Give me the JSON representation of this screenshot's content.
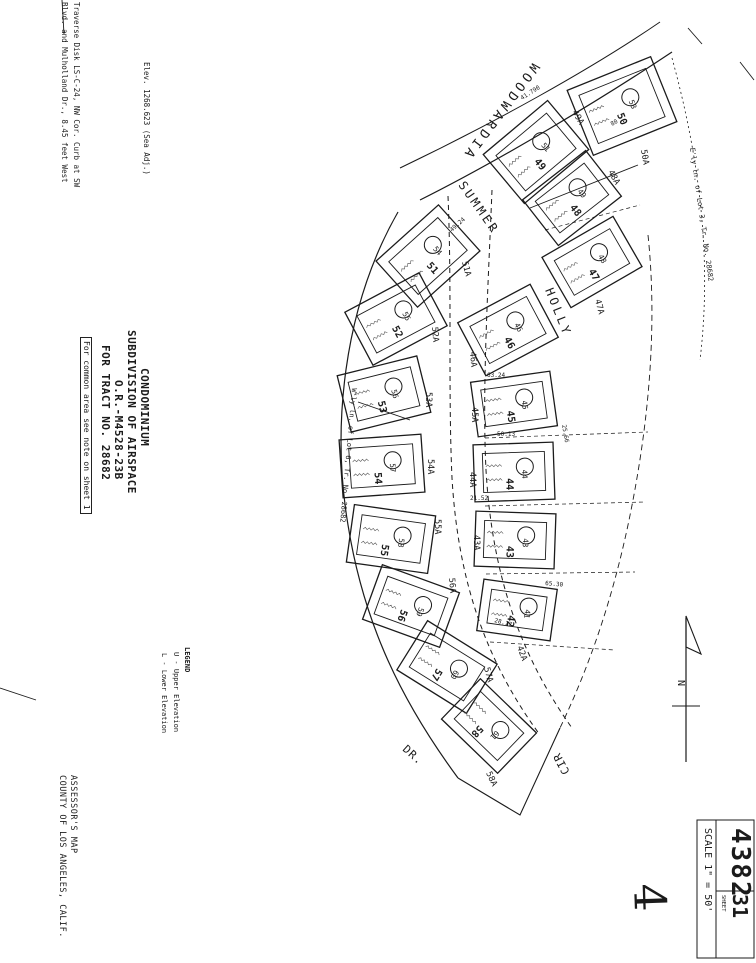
{
  "page_bg": "#ffffff",
  "ink_color": "#1b1b1b",
  "margin_notes": {
    "traverse_line1": "Traverse Disk LS-C-24, NW Cor. Curb at SW",
    "traverse_line2": "Blvd. and Mulholland Dr., 8.45 feet West",
    "elevation_note": "Elev. 1268.623  (Sea Adj.)"
  },
  "title_block": {
    "line1": "CONDOMINIUM",
    "line2": "SUBDIVISION OF AIRSPACE",
    "line3": "O.R.-M4528-23B",
    "line4": "FOR TRACT NO. 28682",
    "boxed_note": "For common area see note on sheet 1"
  },
  "legend": {
    "title": "LEGEND",
    "items": [
      "U - Upper Elevation",
      "L - Lower Elevation"
    ]
  },
  "footer": {
    "line1": "ASSESSOR'S MAP",
    "line2": "COUNTY OF LOS ANGELES, CALIF."
  },
  "sheet_box": {
    "book": "4382",
    "sheet": "31",
    "sheet_label": "SHEET",
    "scale": "SCALE 1\" = 50'"
  },
  "boundary_notes": {
    "east": "E'ly ln. of Lot 3, Tr. No. 28682",
    "west": "W'ly ln. of Lot 6, Tr. No. 28682"
  },
  "north_label": "N",
  "handwritten_mark": "4",
  "map": {
    "streets": [
      {
        "id": "woodwardia",
        "name": "WOODWARDIA"
      },
      {
        "id": "summer",
        "name": "SUMMER"
      },
      {
        "id": "holly",
        "name": "HOLLY"
      },
      {
        "id": "dr",
        "name": "DR."
      },
      {
        "id": "cir",
        "name": "CIR"
      }
    ],
    "parcels": [
      {
        "lot": "49",
        "unit": "51",
        "cx": 536,
        "cy": 152,
        "w": 84,
        "h": 64,
        "rot": -40
      },
      {
        "lot": "50",
        "unit": "53",
        "cx": 622,
        "cy": 106,
        "w": 90,
        "h": 70,
        "rot": -22
      },
      {
        "lot": "48",
        "unit": "49",
        "cx": 572,
        "cy": 198,
        "w": 80,
        "h": 58,
        "rot": -38
      },
      {
        "lot": "47",
        "unit": "48",
        "cx": 592,
        "cy": 262,
        "w": 82,
        "h": 58,
        "rot": -30
      },
      {
        "lot": "46",
        "unit": "46",
        "cx": 508,
        "cy": 330,
        "w": 82,
        "h": 60,
        "rot": -28
      },
      {
        "lot": "45",
        "unit": "45",
        "cx": 514,
        "cy": 404,
        "w": 80,
        "h": 55,
        "rot": -8
      },
      {
        "lot": "44",
        "unit": "44",
        "cx": 514,
        "cy": 472,
        "w": 80,
        "h": 57,
        "rot": -2
      },
      {
        "lot": "43",
        "unit": "43",
        "cx": 515,
        "cy": 540,
        "w": 80,
        "h": 55,
        "rot": 2
      },
      {
        "lot": "42",
        "unit": "41",
        "cx": 517,
        "cy": 610,
        "w": 74,
        "h": 52,
        "rot": 8
      },
      {
        "lot": "51",
        "unit": "54",
        "cx": 428,
        "cy": 256,
        "w": 84,
        "h": 62,
        "rot": -42
      },
      {
        "lot": "52",
        "unit": "55",
        "cx": 396,
        "cy": 319,
        "w": 84,
        "h": 60,
        "rot": -28
      },
      {
        "lot": "53",
        "unit": "56",
        "cx": 384,
        "cy": 394,
        "w": 82,
        "h": 58,
        "rot": -14
      },
      {
        "lot": "54",
        "unit": "57",
        "cx": 382,
        "cy": 466,
        "w": 82,
        "h": 58,
        "rot": -4
      },
      {
        "lot": "55",
        "unit": "58",
        "cx": 391,
        "cy": 539,
        "w": 82,
        "h": 58,
        "rot": 8
      },
      {
        "lot": "56",
        "unit": "59",
        "cx": 411,
        "cy": 606,
        "w": 82,
        "h": 58,
        "rot": 20
      },
      {
        "lot": "57",
        "unit": "60",
        "cx": 447,
        "cy": 667,
        "w": 82,
        "h": 58,
        "rot": 32
      },
      {
        "lot": "58",
        "unit": "61",
        "cx": 489,
        "cy": 726,
        "w": 78,
        "h": 56,
        "rot": 44
      }
    ],
    "lot_labels": [
      {
        "text": "49A",
        "x": 572,
        "y": 112,
        "rot": 60
      },
      {
        "text": "50A",
        "x": 641,
        "y": 150,
        "rot": 80
      },
      {
        "text": "48A",
        "x": 608,
        "y": 172,
        "rot": 60
      },
      {
        "text": "47A",
        "x": 595,
        "y": 300,
        "rot": 75
      },
      {
        "text": "51A",
        "x": 462,
        "y": 262,
        "rot": 75
      },
      {
        "text": "52A",
        "x": 432,
        "y": 327,
        "rot": 85
      },
      {
        "text": "46A",
        "x": 470,
        "y": 352,
        "rot": 85
      },
      {
        "text": "53A",
        "x": 426,
        "y": 392,
        "rot": 90
      },
      {
        "text": "45A",
        "x": 472,
        "y": 407,
        "rot": 90
      },
      {
        "text": "54A",
        "x": 428,
        "y": 459,
        "rot": 90
      },
      {
        "text": "44A",
        "x": 470,
        "y": 472,
        "rot": 90
      },
      {
        "text": "55A",
        "x": 435,
        "y": 519,
        "rot": 90
      },
      {
        "text": "43A",
        "x": 474,
        "y": 535,
        "rot": 90
      },
      {
        "text": "56A",
        "x": 449,
        "y": 578,
        "rot": 85
      },
      {
        "text": "42A",
        "x": 517,
        "y": 647,
        "rot": 70
      },
      {
        "text": "57A",
        "x": 484,
        "y": 668,
        "rot": 75
      },
      {
        "text": "58A",
        "x": 486,
        "y": 773,
        "rot": 65
      }
    ],
    "dimensions": [
      {
        "text": "41.790",
        "x": 522,
        "y": 100,
        "rot": -32
      },
      {
        "text": "49.24",
        "x": 452,
        "y": 232,
        "rot": -42
      },
      {
        "text": "63.24",
        "x": 487,
        "y": 377,
        "rot": 0
      },
      {
        "text": "50.13",
        "x": 497,
        "y": 436,
        "rot": 0
      },
      {
        "text": "21.52",
        "x": 470,
        "y": 500,
        "rot": 0
      },
      {
        "text": "28.17",
        "x": 494,
        "y": 622,
        "rot": 15
      },
      {
        "text": "25.66",
        "x": 562,
        "y": 425,
        "rot": 80
      },
      {
        "text": "80",
        "x": 612,
        "y": 126,
        "rot": -30
      },
      {
        "text": "65.30",
        "x": 545,
        "y": 585,
        "rot": 5
      }
    ]
  }
}
